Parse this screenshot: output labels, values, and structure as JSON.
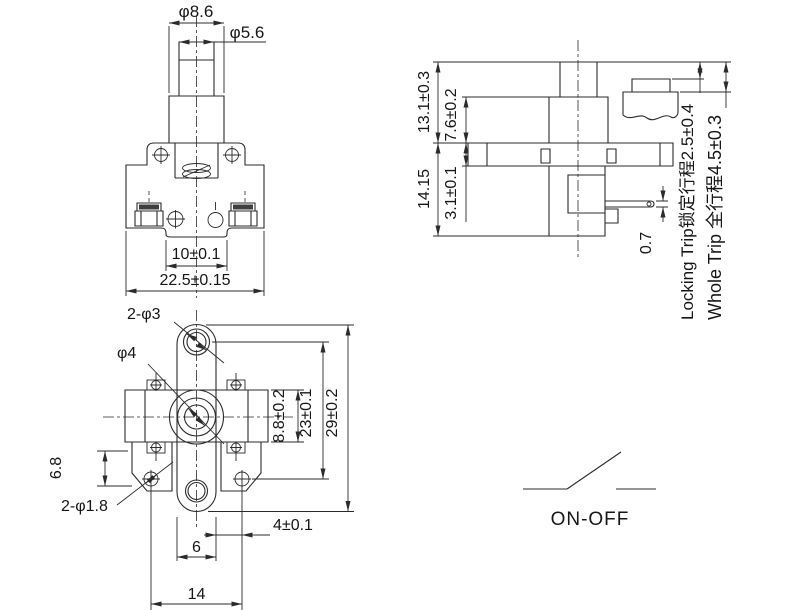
{
  "style": {
    "line_color": "#2b2b2b",
    "text_color": "#161616",
    "background": "#ffffff"
  },
  "views": {
    "front": {
      "labels": {
        "cap_dia": "φ8.6",
        "shaft_dia": "φ5.6",
        "slot_width": "10±0.1",
        "body_width": "22.5±0.15"
      }
    },
    "side": {
      "labels": {
        "upper_height": "13.1±0.3",
        "body_height": "7.6±0.2",
        "lower_height": "14.15",
        "plate_thickness": "3.1±0.1",
        "pin_thickness": "0.7",
        "locking_trip": "Locking Trip锁定行程2.5±0.4",
        "whole_trip": "Whole Trip 全行程4.5±0.3"
      }
    },
    "bottom": {
      "labels": {
        "ear_holes": "2-φ3",
        "center_hole": "φ4",
        "lug_height": "6.8",
        "small_holes": "2-φ1.8",
        "body_height": "8.8±0.2",
        "hole_span": "23±0.1",
        "overall_height": "29±0.2",
        "pin_offset": "4±0.1",
        "pin_width": "6",
        "lug_span": "14"
      }
    },
    "circuit": {
      "label": "ON-OFF"
    }
  }
}
